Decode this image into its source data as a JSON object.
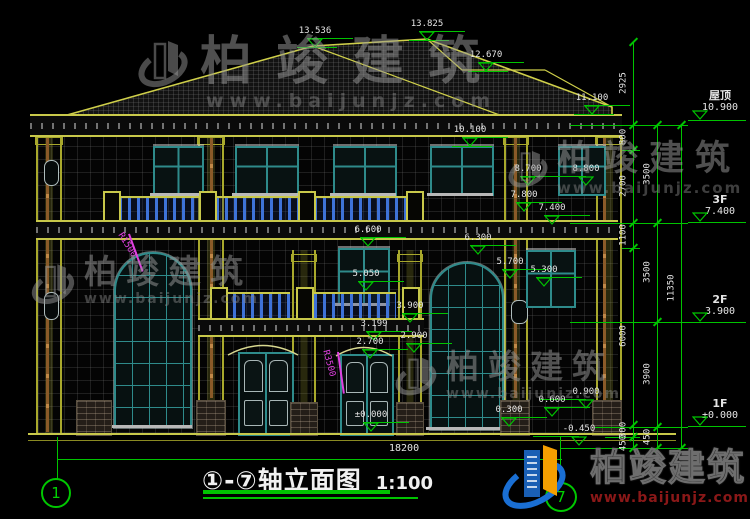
{
  "drawing": {
    "title": "①-⑦轴立面图",
    "scale": "1:100",
    "bottom_width_dim": "18200",
    "axis_bubble_start": "1",
    "axis_bubble_end": "7"
  },
  "watermark": {
    "brand": "柏竣建筑",
    "url": "www.baijunjz.com"
  },
  "logo": {
    "brand": "柏竣建筑",
    "url": "www.baijunjz.com"
  },
  "colors": {
    "dim_green": "#00c400",
    "line_yellow": "#b8b832",
    "window_teal": "#2e8b8b",
    "balcony_blue": "#3e72d8",
    "magenta": "#e040e0",
    "logo_blue": "#1a6fd4",
    "logo_orange": "#f59f00",
    "logo_red": "#8a1818"
  },
  "right_levels": [
    {
      "name": "屋顶",
      "value": "10.900",
      "ty": 90,
      "line_y": 120
    },
    {
      "name": "3F",
      "value": "7.400",
      "ty": 194,
      "line_y": 222
    },
    {
      "name": "2F",
      "value": "3.900",
      "ty": 294,
      "line_y": 322
    },
    {
      "name": "1F",
      "value": "±0.000",
      "ty": 398,
      "line_y": 426
    }
  ],
  "peak_markers": [
    {
      "label": "13.536",
      "x": 315,
      "y": 48
    },
    {
      "label": "13.825",
      "x": 427,
      "y": 41
    },
    {
      "label": "12.670",
      "x": 486,
      "y": 72
    },
    {
      "label": "11.100",
      "x": 592,
      "y": 115
    },
    {
      "label": "10.100",
      "x": 470,
      "y": 147
    }
  ],
  "level_markers": [
    {
      "label": "8.700",
      "x": 528,
      "y": 186
    },
    {
      "label": "8.800",
      "x": 586,
      "y": 186,
      "d": "l"
    },
    {
      "label": "7.800",
      "x": 524,
      "y": 212
    },
    {
      "label": "7.400",
      "x": 552,
      "y": 225
    },
    {
      "label": "6.600",
      "x": 368,
      "y": 247
    },
    {
      "label": "6.300",
      "x": 478,
      "y": 255
    },
    {
      "label": "5.700",
      "x": 510,
      "y": 279
    },
    {
      "label": "5.300",
      "x": 544,
      "y": 287
    },
    {
      "label": "5.050",
      "x": 366,
      "y": 291
    },
    {
      "label": "3.900",
      "x": 410,
      "y": 323
    },
    {
      "label": "3.199",
      "x": 374,
      "y": 341
    },
    {
      "label": "2.900",
      "x": 414,
      "y": 353
    },
    {
      "label": "2.700",
      "x": 370,
      "y": 359
    },
    {
      "label": "0.900",
      "x": 586,
      "y": 409,
      "d": "l"
    },
    {
      "label": "0.600",
      "x": 552,
      "y": 417
    },
    {
      "label": "0.300",
      "x": 509,
      "y": 427
    },
    {
      "label": "±0.000",
      "x": 371,
      "y": 432
    },
    {
      "label": "-0.450",
      "x": 579,
      "y": 446,
      "d": "l"
    }
  ],
  "radius_labels": [
    {
      "label": "R1500",
      "x": 124,
      "y": 231,
      "angle": 58,
      "line": [
        128,
        234,
        40,
        -20
      ]
    },
    {
      "label": "R3500",
      "x": 330,
      "y": 349,
      "angle": 75,
      "line": [
        337,
        352,
        42,
        -8
      ]
    }
  ],
  "dim_chains": [
    {
      "x": 633,
      "y1": 42,
      "y2": 448,
      "ticks": [
        42,
        125,
        150,
        223,
        248,
        425,
        437,
        448
      ],
      "labels": [
        {
          "text": "2925",
          "y": 83
        },
        {
          "text": "800",
          "y": 137
        },
        {
          "text": "2700",
          "y": 186
        },
        {
          "text": "1100",
          "y": 235
        },
        {
          "text": "6000",
          "y": 336
        },
        {
          "text": "300",
          "y": 430
        },
        {
          "text": "450",
          "y": 443
        }
      ]
    },
    {
      "x": 657,
      "y1": 125,
      "y2": 448,
      "ticks": [
        125,
        223,
        322,
        427,
        448
      ],
      "labels": [
        {
          "text": "3500",
          "y": 174
        },
        {
          "text": "3500",
          "y": 272
        },
        {
          "text": "3900",
          "y": 374
        },
        {
          "text": "450",
          "y": 437
        }
      ]
    },
    {
      "x": 681,
      "y1": 125,
      "y2": 448,
      "ticks": [
        125,
        448
      ],
      "labels": [
        {
          "text": "11350",
          "y": 288
        }
      ]
    }
  ],
  "h_lines": [
    [
      570,
      125,
      118
    ],
    [
      622,
      150,
      18
    ],
    [
      570,
      223,
      118
    ],
    [
      622,
      248,
      18
    ],
    [
      570,
      322,
      118
    ],
    [
      595,
      427,
      93
    ],
    [
      605,
      437,
      35
    ],
    [
      560,
      448,
      128
    ],
    [
      688,
      120,
      58
    ],
    [
      688,
      222,
      58
    ],
    [
      688,
      322,
      58
    ],
    [
      688,
      426,
      58
    ],
    [
      57,
      459,
      505
    ],
    [
      297,
      47,
      40
    ],
    [
      409,
      40,
      40
    ],
    [
      468,
      71,
      40
    ],
    [
      574,
      114,
      40
    ],
    [
      452,
      146,
      40
    ]
  ],
  "v_lines": [
    [
      57,
      437,
      42
    ],
    [
      560,
      437,
      46
    ]
  ]
}
